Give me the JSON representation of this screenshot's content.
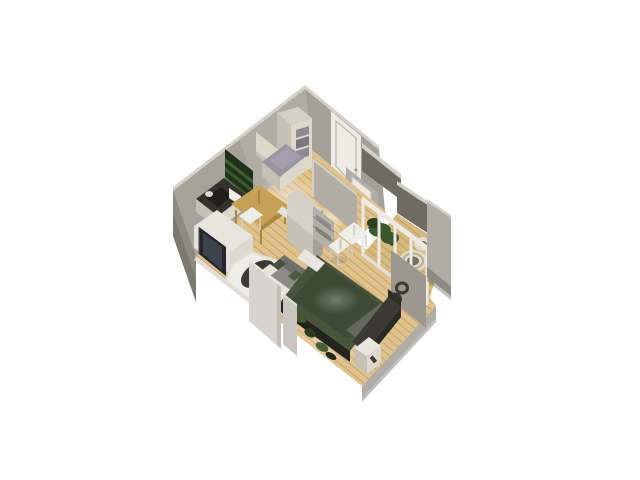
{
  "scene": {
    "kind": "isometric-3d-floor-plan",
    "background": "#ffffff",
    "rooms": [
      {
        "name": "kitchen-dining",
        "items": [
          "green-wall-shelves",
          "cream-upper-cabinets",
          "tall-cabinet-gray-boxes",
          "dark-counter-appliances",
          "wood-dining-table",
          "white-chairs"
        ]
      },
      {
        "name": "living-room",
        "items": [
          "tv",
          "tv-sideboard",
          "white-console-table",
          "white-shag-rug",
          "dark-oval-coffee-table",
          "gray-sofa-green-pillows"
        ]
      },
      {
        "name": "hallway",
        "items": [
          "white-entry-door",
          "partition-wall",
          "wardrobe",
          "open-shelf-unit",
          "white-stool"
        ]
      },
      {
        "name": "bedroom",
        "items": [
          "green-double-bed",
          "gray-blanket",
          "dark-headboard",
          "white-foot-bench",
          "white-nightstand",
          "white-desk",
          "scattered-green-clothes",
          "ring-wall-decor"
        ]
      },
      {
        "name": "balcony",
        "items": [
          "white-glass-sliding-doors",
          "green-planter",
          "round-rattan-chair",
          "round-side-table"
        ]
      }
    ]
  },
  "palette": {
    "background": "#ffffff",
    "wall-inner": "#b1ada4",
    "wall-inner-dark": "#9d988f",
    "wall-outer": "#8e8a81",
    "wall-dark": "#6f6b63",
    "wall-top": "#d4d0c7",
    "panel-light": "#d7d4cd",
    "floor-base": "#e2c28c",
    "floor-stripe": "#a9833f",
    "floor-balcony": "#d8ba81",
    "door-white": "#eeebe4",
    "cabinet-cream": "#ddd8ca",
    "cabinet-shadow": "#c5c1b4",
    "counter-dark": "#34322c",
    "appliance-black": "#1f1e1a",
    "shelf-green-dark": "#1f3117",
    "shelf-green": "#43642f",
    "table-wood": "#c79f57",
    "table-wood-dark": "#a9863f",
    "chair-white": "#edeee8",
    "sideboard-white": "#e8e5de",
    "tv-dark": "#23262b",
    "tv-screen": "#3c434e",
    "rug-white": "#efede7",
    "coffee-table-dark": "#3b3933",
    "sofa-gray": "#8b8b84",
    "sofa-gray-dark": "#70706a",
    "sofa-frame": "#e5e3dc",
    "pillow-green": "#43533b",
    "bed-green": "#47553d",
    "bed-green-dark": "#3d4b34",
    "bed-base-dark": "#24241f",
    "headboard-dark": "#3a3934",
    "blanket-gray": "#6c6c64",
    "nightstand-white": "#e9e6df",
    "plant-green": "#39582b",
    "plant-green-dark": "#2a421f",
    "rattan-cream": "#e3dcc9",
    "rattan-center": "#74705f",
    "ring-dark": "#3b3933",
    "box-gray": "#8e8a94",
    "clothes-green": "#41572f",
    "clothes-green-dark": "#2c3d21"
  }
}
